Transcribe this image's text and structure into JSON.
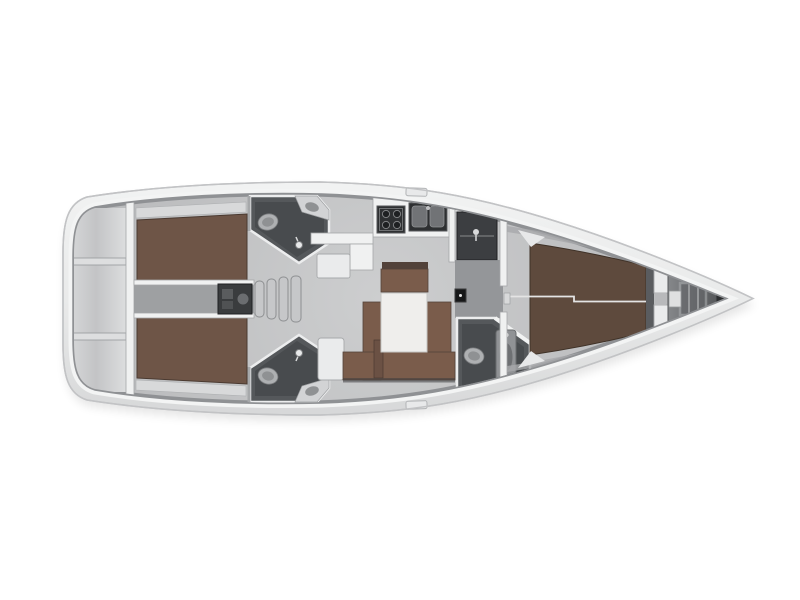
{
  "scene": {
    "kind": "sailing-yacht-interior-floor-plan",
    "view": "top-down",
    "orientation": "bow-right-stern-left",
    "visible_text": "none"
  },
  "rooms": [
    "swim-platform-transom",
    "aft-double-cabin-port",
    "aft-double-cabin-starboard",
    "engine-compartment",
    "companionway-steps",
    "aft-head-port",
    "aft-head-starboard",
    "galley",
    "salon-dinette-with-table",
    "wardrobe-locker",
    "forward-head-with-shower",
    "forward-double-cabin",
    "anchor-locker-bow"
  ],
  "icons": [
    "toilet-icon",
    "sink-icon",
    "stove-icon",
    "double-sink-icon",
    "shower-mixer-icon",
    "coat-hanger-icon",
    "bed-icon",
    "table-icon",
    "bow-ladder-icon",
    "deck-hatch-icon"
  ],
  "colors": {
    "background": "#ffffff",
    "hull_fill": "#f8f9f9",
    "hull_stroke": "#c2c3c5",
    "deck_light": "#f2f3f3",
    "deck_mid": "#e9eaea",
    "deck_dark": "#d5d6d7",
    "cap_white": "#f3f4f4",
    "ring_shadow": "#8f9194",
    "floor_light": "#cdcecf",
    "floor_dark": "#b6b7b9",
    "wall_white": "#f0f1f1",
    "wall_stroke": "#a5a7a9",
    "bed_brown": "#6e5547",
    "bed_brown_dark": "#5e4a3d",
    "seat_brown": "#7a5c4b",
    "wood_dark": "#52423a",
    "table_white": "#efeeec",
    "head_wall": "#55585b",
    "head_floor": "#484b4e",
    "fixture": "#aeb0b2",
    "fixture_dark": "#8f9193",
    "appliance": "#2e3032",
    "steel": "#717376",
    "wardrobe": "#3c3e41",
    "passage": "#8b8d90",
    "locker_gray": "#85878a",
    "locker_tip": "#2d2f31",
    "step_gray": "#c6c7c9",
    "step_stroke": "#8d8f91",
    "shelf_gray": "#d8d9da",
    "panel_black": "#161718"
  }
}
